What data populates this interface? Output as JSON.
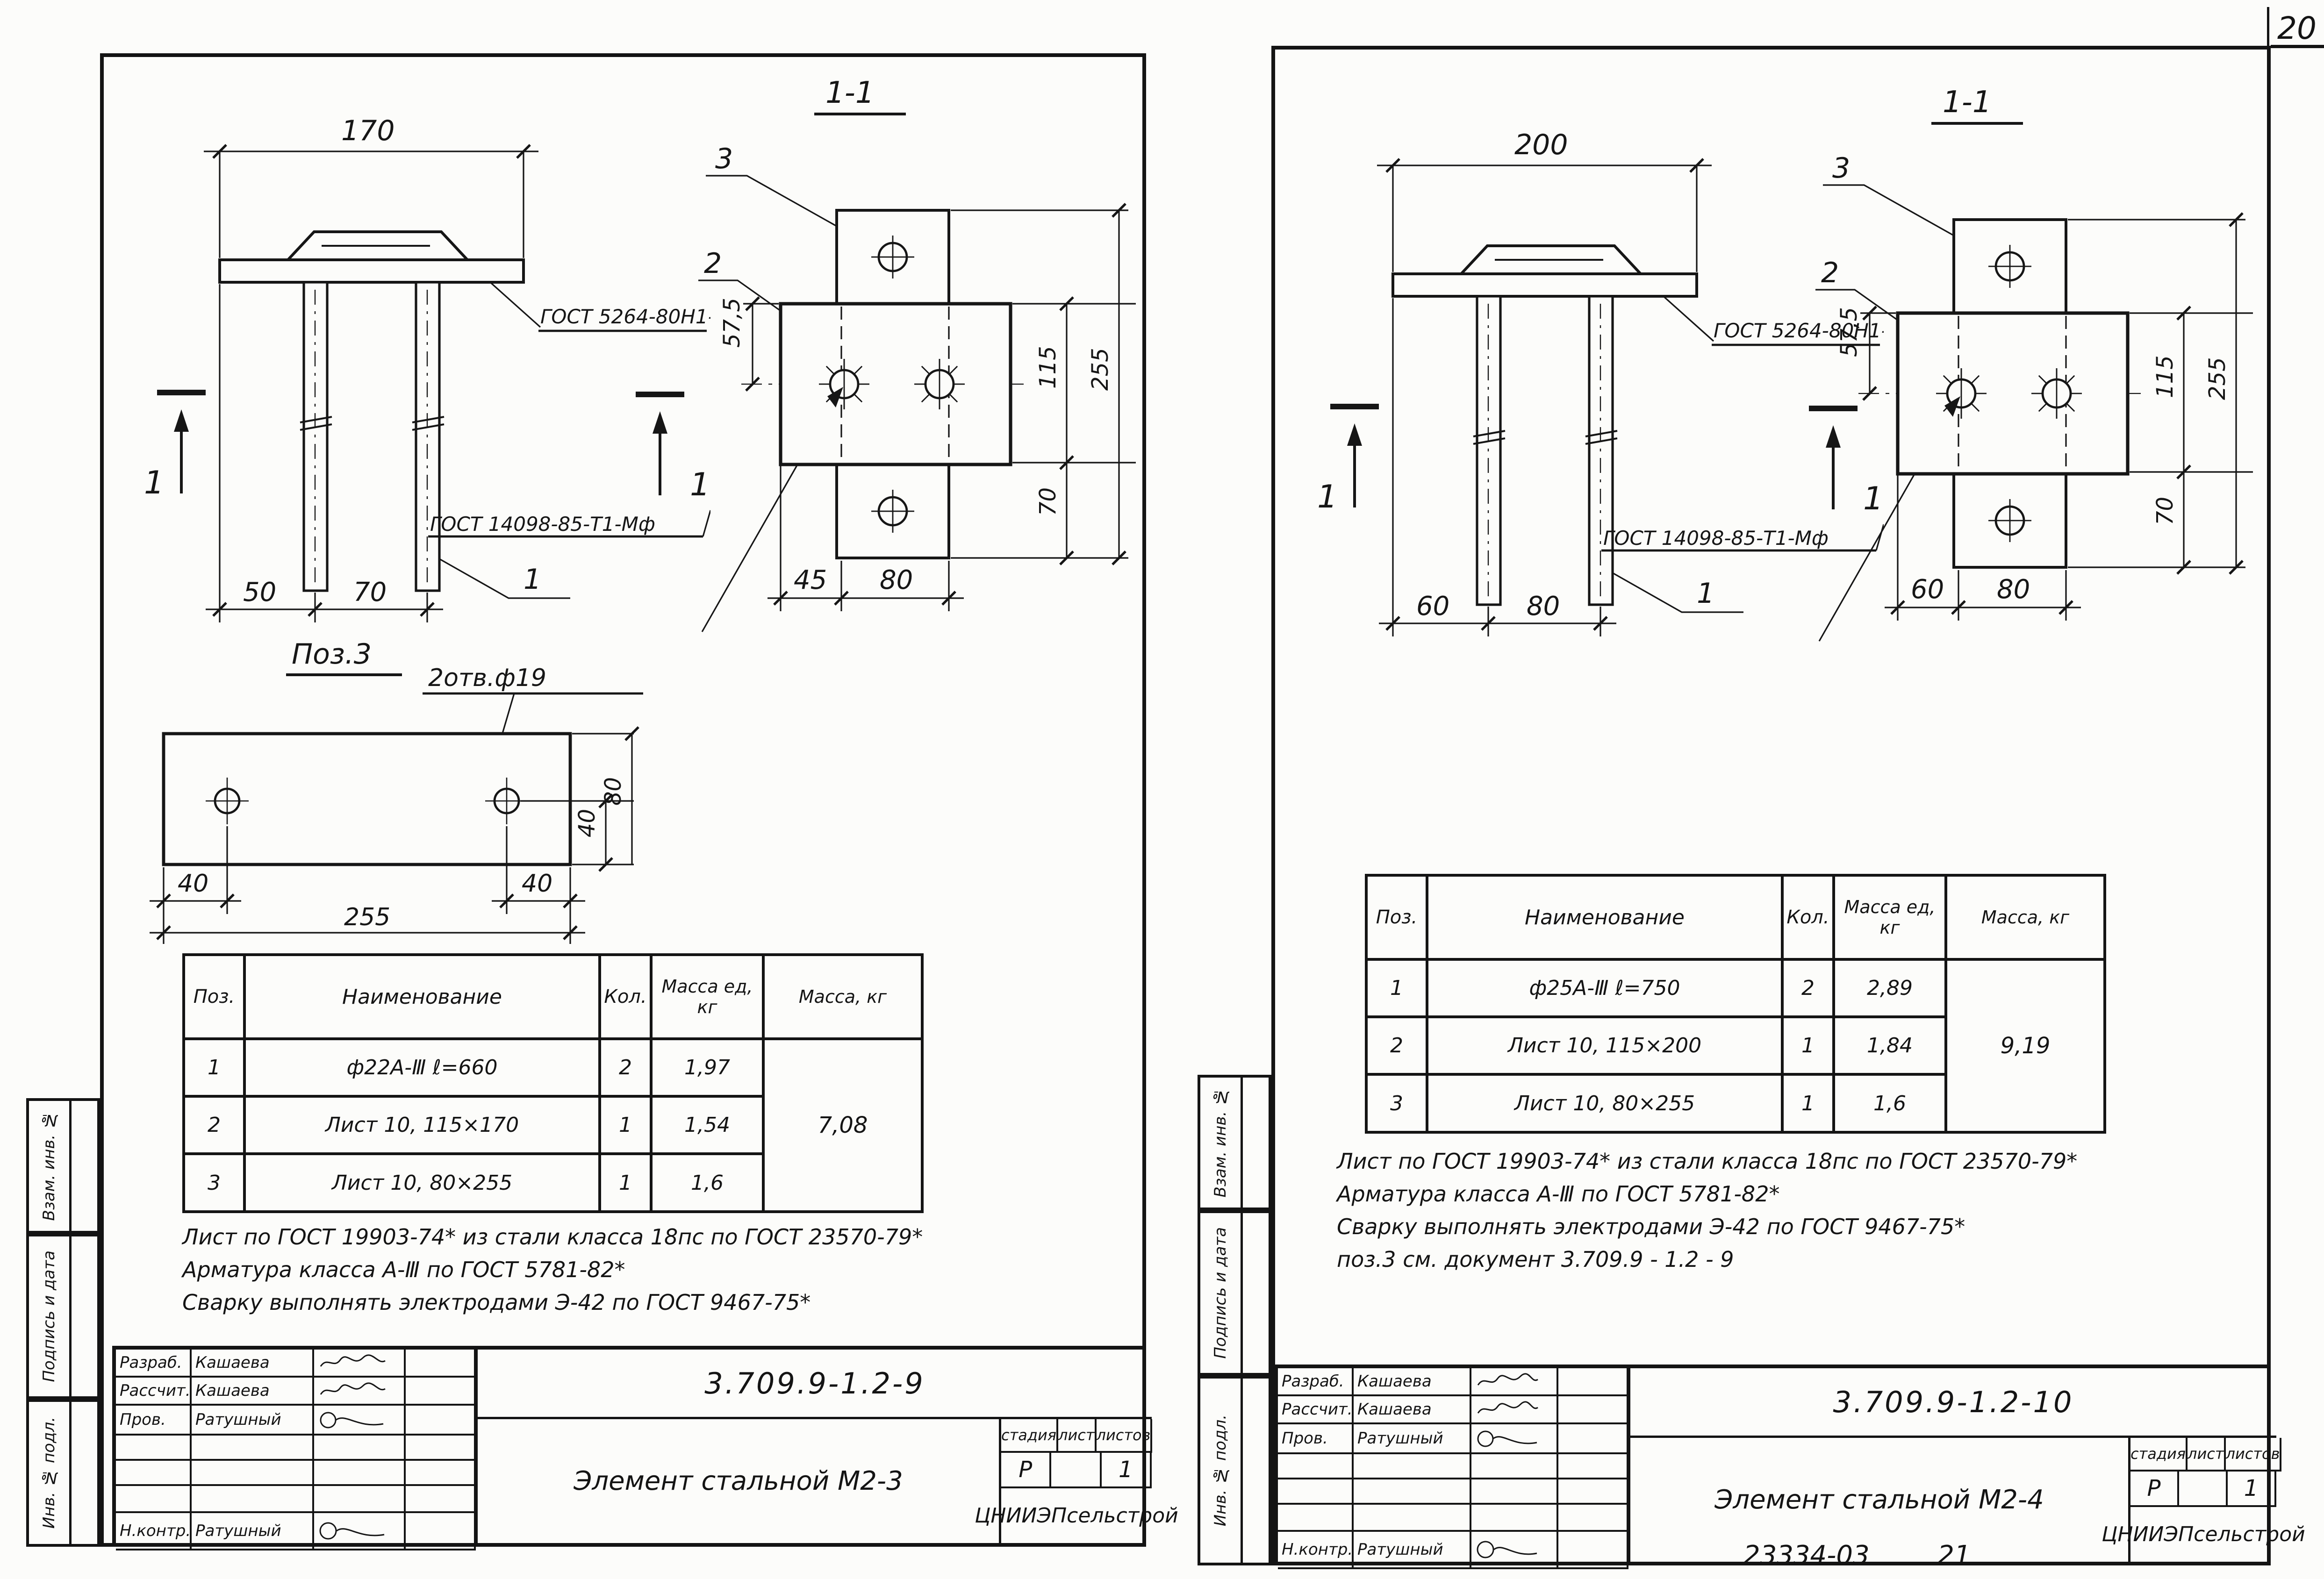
{
  "page": {
    "number": "20",
    "footer_code": "23334-03",
    "footer_num": "21"
  },
  "margin": {
    "top": "Взам. инв. №",
    "mid": "Подпись и дата",
    "bot": "Инв. № подл."
  },
  "left": {
    "elev": {
      "top_dim": "170",
      "d1": "50",
      "d2": "70",
      "sec_mark": "1",
      "bar_label": "1",
      "weld_top": "ГОСТ 5264-80Н1-△6",
      "weld_bottom": "ГОСТ 14098-85-Т1-Мф"
    },
    "sec": {
      "title": "1-1",
      "pos3": "3",
      "pos2": "2",
      "dim_half": "57,5",
      "dim_mid": "115",
      "dim_all": "255",
      "dim_bot": "70",
      "b1": "45",
      "b2": "80"
    },
    "det": {
      "title": "Поз.3",
      "holes": "2отв.ф19",
      "b1": "40",
      "b2": "40",
      "overall": "255",
      "v1": "40",
      "v2": "80"
    },
    "table": {
      "h1": "Поз.",
      "h2": "Наименование",
      "h3": "Кол.",
      "h4": "Масса ед, кг",
      "h5": "Масса, кг",
      "r1": [
        "1",
        "ф22А-Ⅲ  ℓ=660",
        "2",
        "1,97"
      ],
      "r2": [
        "2",
        "Лист 10, 115×170",
        "1",
        "1,54"
      ],
      "r3": [
        "3",
        "Лист 10, 80×255",
        "1",
        "1,6"
      ],
      "total": "7,08"
    },
    "notes": [
      "Лист по ГОСТ 19903-74* из стали класса 18пс по ГОСТ 23570-79*",
      "Арматура класса А-Ⅲ по ГОСТ 5781-82*",
      "Сварку выполнять электродами Э-42 по ГОСТ 9467-75*"
    ],
    "stamp": {
      "r1l": "Разраб.",
      "r1n": "Кашаева",
      "r2l": "Рассчит.",
      "r2n": "Кашаева",
      "r3l": "Пров.",
      "r3n": "Ратушный",
      "r4l": "Н.контр.",
      "r4n": "Ратушный",
      "doc": "3.709.9-1.2-9",
      "title": "Элемент стальной М2-3",
      "c1": "стадия",
      "c2": "лист",
      "c3": "листов",
      "stage": "Р",
      "sheets": "1",
      "org": "ЦНИИЭПсельстрой"
    }
  },
  "right": {
    "elev": {
      "top_dim": "200",
      "d1": "60",
      "d2": "80",
      "sec_mark": "1",
      "bar_label": "1",
      "weld_top": "ГОСТ 5264-80Н1-△6",
      "weld_bottom": "ГОСТ 14098-85-Т1-Мф"
    },
    "sec": {
      "title": "1-1",
      "pos3": "3",
      "pos2": "2",
      "dim_half": "57,5",
      "dim_mid": "115",
      "dim_all": "255",
      "dim_bot": "70",
      "b1": "60",
      "b2": "80"
    },
    "table": {
      "h1": "Поз.",
      "h2": "Наименование",
      "h3": "Кол.",
      "h4": "Масса ед, кг",
      "h5": "Масса, кг",
      "r1": [
        "1",
        "ф25А-Ⅲ  ℓ=750",
        "2",
        "2,89"
      ],
      "r2": [
        "2",
        "Лист 10, 115×200",
        "1",
        "1,84"
      ],
      "r3": [
        "3",
        "Лист 10, 80×255",
        "1",
        "1,6"
      ],
      "total": "9,19"
    },
    "notes": [
      "Лист по ГОСТ 19903-74* из стали класса 18пс по ГОСТ 23570-79*",
      "Арматура класса А-Ⅲ по ГОСТ 5781-82*",
      "Сварку выполнять электродами Э-42 по ГОСТ 9467-75*",
      "поз.3 см. документ 3.709.9 - 1.2 - 9"
    ],
    "stamp": {
      "r1l": "Разраб.",
      "r1n": "Кашаева",
      "r2l": "Рассчит.",
      "r2n": "Кашаева",
      "r3l": "Пров.",
      "r3n": "Ратушный",
      "r4l": "Н.контр.",
      "r4n": "Ратушный",
      "doc": "3.709.9-1.2-10",
      "title": "Элемент стальной М2-4",
      "c1": "стадия",
      "c2": "лист",
      "c3": "листов",
      "stage": "Р",
      "sheets": "1",
      "org": "ЦНИИЭПсельстрой"
    }
  }
}
